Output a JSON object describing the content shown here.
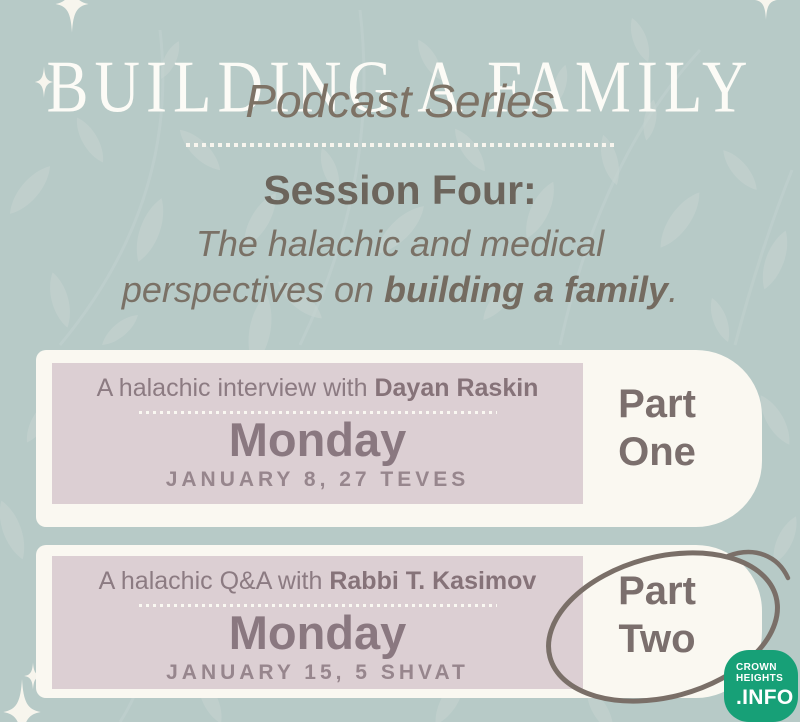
{
  "header": {
    "title": "BUILDING A FAMILY",
    "subtitle": "Podcast Series"
  },
  "session": {
    "heading": "Session Four:",
    "line1": "The halachic and medical",
    "line2_pre": "perspectives on ",
    "line2_bold": "building a family",
    "line2_end": "."
  },
  "cards": [
    {
      "intro": "A halachic interview with ",
      "speaker": "Dayan Raskin",
      "day": "Monday",
      "date": "JANUARY 8, 27 TEVES",
      "part_line1": "Part",
      "part_line2": "One",
      "circled": false
    },
    {
      "intro": "A halachic Q&A with ",
      "speaker": "Rabbi T. Kasimov",
      "day": "Monday",
      "date": "JANUARY 15, 5 SHVAT",
      "part_line1": "Part",
      "part_line2": "Two",
      "circled": true
    }
  ],
  "logo": {
    "line1": "CROWN",
    "line2": "HEIGHTS",
    "line3": ".INFO"
  },
  "colors": {
    "background": "#b7cac7",
    "leaf_pattern": "#c5d3d0",
    "card_cream": "#faf8f1",
    "accent_mauve": "#dccfd3",
    "text_brown": "#6c655c",
    "text_mauve": "#8a7880",
    "circle_stroke": "#7a6f68",
    "logo_green": "#17a077",
    "sparkle_white": "#f7f5ed"
  }
}
